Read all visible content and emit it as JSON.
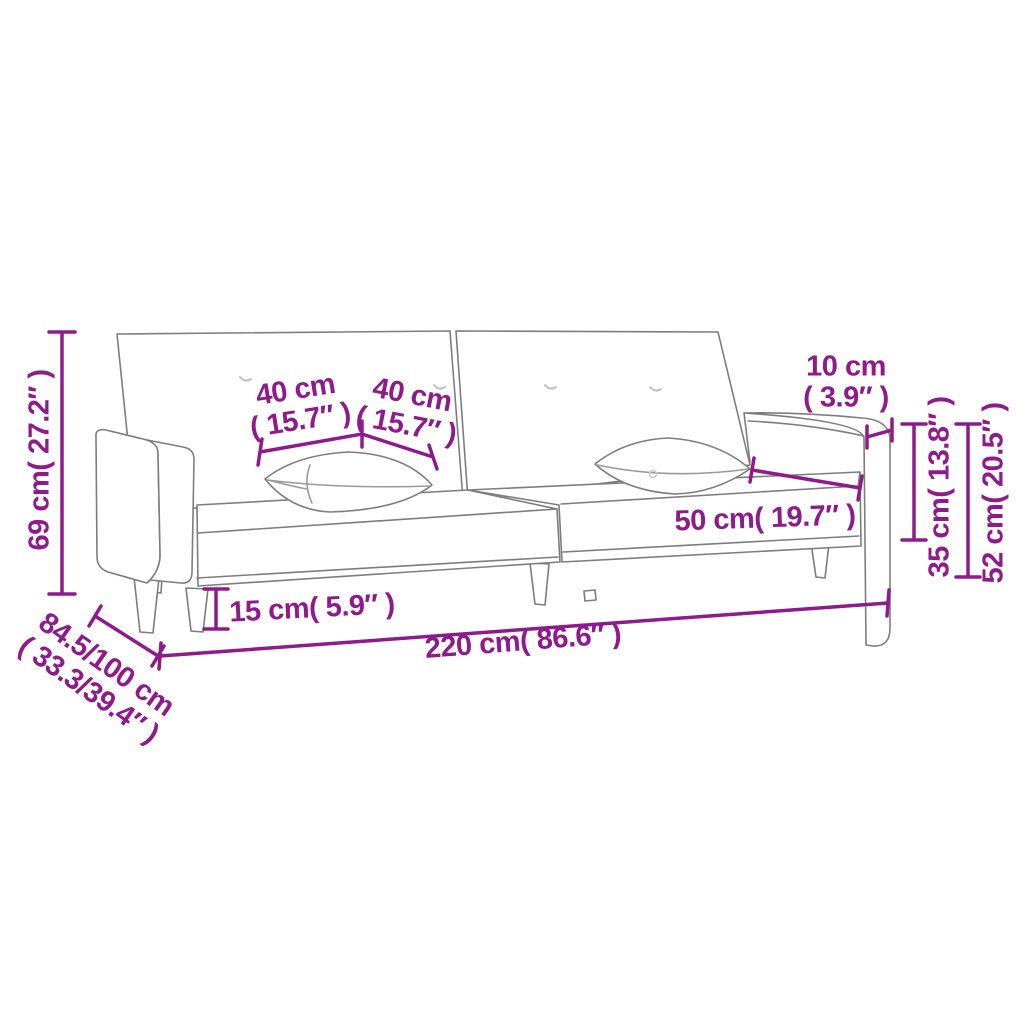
{
  "diagram": {
    "subject": "sofa-bed-with-two-pillows-dimension-drawing",
    "colors": {
      "dimension_accent": "#8E1A8C",
      "drawing_outline": "#7D7D7D",
      "background": "#FFFFFF"
    },
    "labels": {
      "height": {
        "text": "69 cm( 27.2″ )"
      },
      "depth": {
        "line1": "84.5/100 cm",
        "line2": "( 33.3/39.4″ )"
      },
      "width": {
        "text": "220 cm( 86.6″ )"
      },
      "leg_height": {
        "text": "15 cm( 5.9″ )"
      },
      "pillow_left": {
        "line1": "40 cm",
        "line2": "( 15.7″ )"
      },
      "pillow_right": {
        "line1": "40 cm",
        "line2": "( 15.7″ )"
      },
      "armrest_width": {
        "line1": "10 cm",
        "line2": "( 3.9″ )"
      },
      "seat_depth": {
        "text": "50 cm( 19.7″ )"
      },
      "armrest_height": {
        "text": "35 cm( 13.8″ )"
      },
      "backrest_height": {
        "text": "52 cm( 20.5″ )"
      }
    }
  }
}
